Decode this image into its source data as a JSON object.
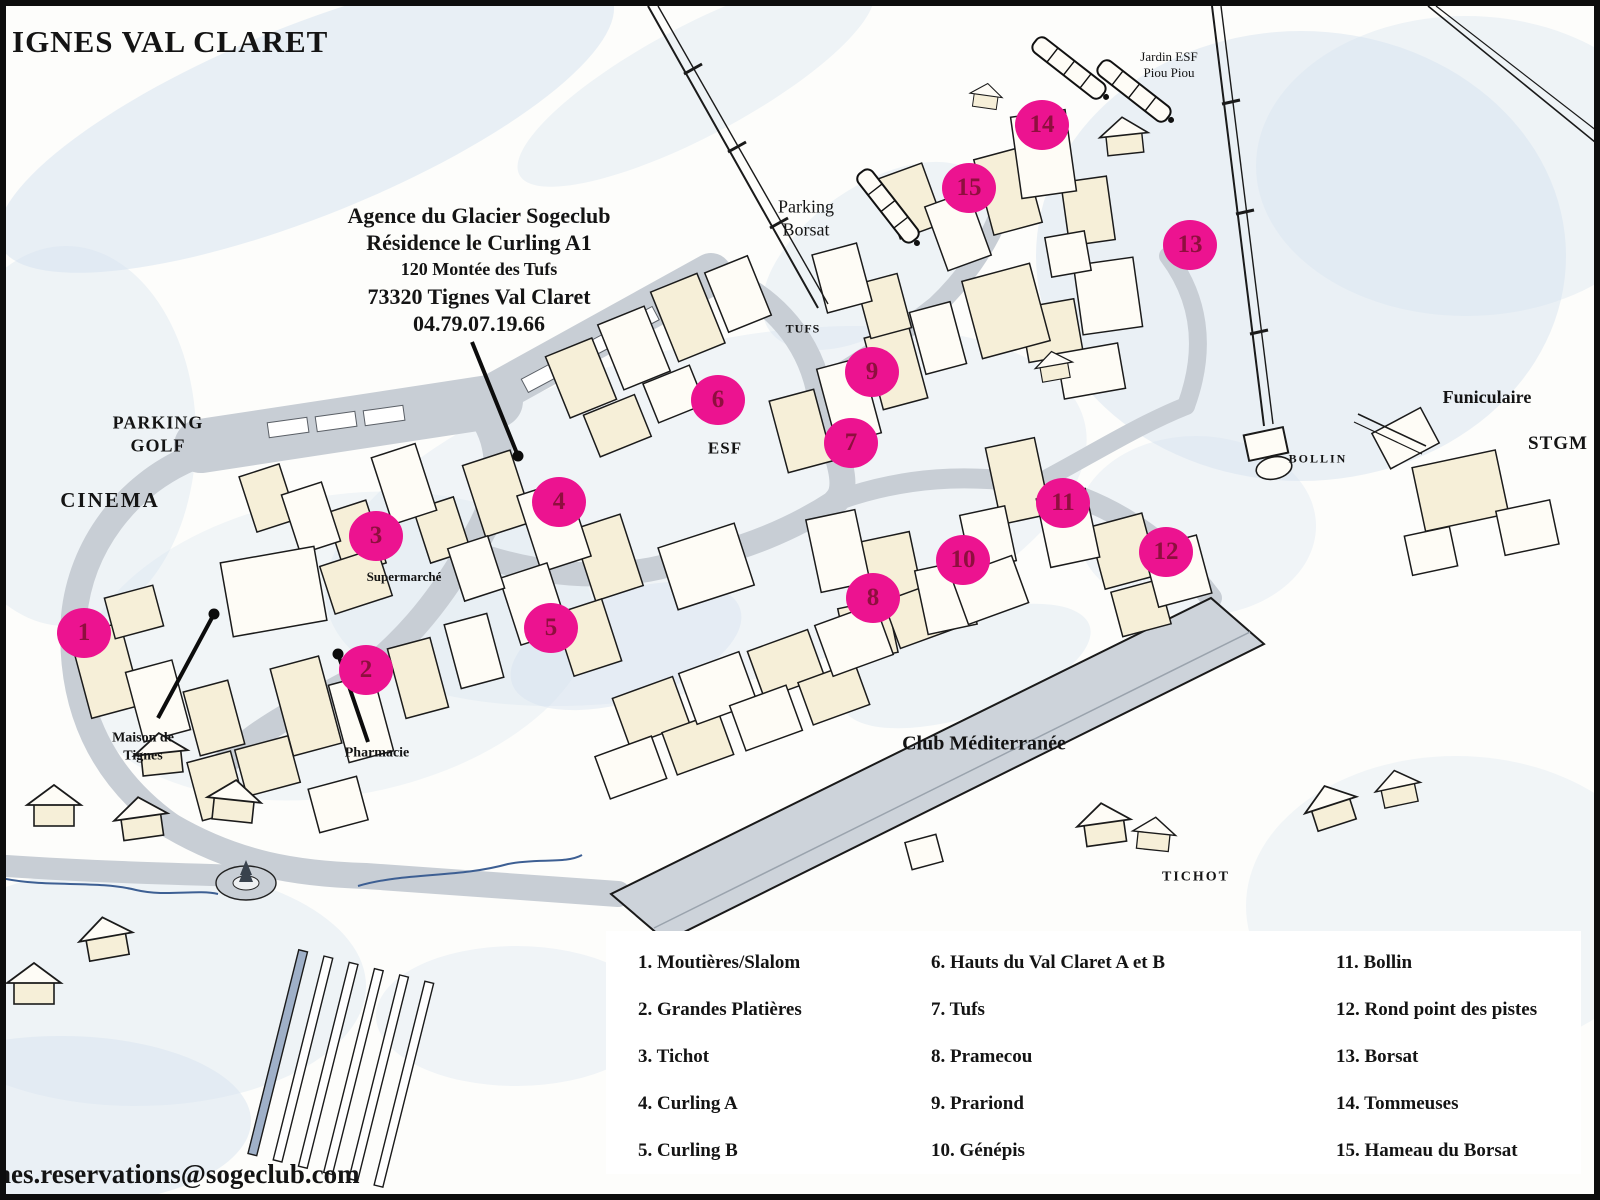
{
  "title": "IGNES VAL CLARET",
  "agency": {
    "line1": "Agence du Glacier Sogeclub",
    "line2": "Résidence le Curling A1",
    "line3": "120 Montée des Tufs",
    "line4": "73320 Tignes Val Claret",
    "line5": "04.79.07.19.66"
  },
  "email": "nes.reservations@sogeclub.com",
  "colors": {
    "marker_fill": "#ec1390",
    "marker_number": "#8e0f3e",
    "road": "#c8ced5",
    "wash": "#d7e3f0",
    "building_cream": "#f6efd8",
    "building_white": "#fefcf6"
  },
  "map_labels": [
    {
      "id": "parking-golf",
      "lines": [
        "PARKING",
        "GOLF"
      ],
      "x": 152,
      "y": 428,
      "size": 18,
      "weight": "bold",
      "ls": 1
    },
    {
      "id": "cinema",
      "lines": [
        "CINEMA"
      ],
      "x": 104,
      "y": 494,
      "size": 21,
      "weight": "bold",
      "ls": 2
    },
    {
      "id": "supermarche",
      "lines": [
        "Supermarché"
      ],
      "x": 398,
      "y": 571,
      "size": 13,
      "weight": "bold",
      "ls": 0
    },
    {
      "id": "maison-de-tignes",
      "lines": [
        "Maison de",
        "Tignes"
      ],
      "x": 137,
      "y": 741,
      "size": 14,
      "weight": "bold",
      "ls": 0
    },
    {
      "id": "pharmacie",
      "lines": [
        "Pharmacie"
      ],
      "x": 371,
      "y": 747,
      "size": 14,
      "weight": "bold",
      "ls": 0
    },
    {
      "id": "parking-borsat",
      "lines": [
        "Parking",
        "Borsat"
      ],
      "x": 800,
      "y": 212,
      "size": 18,
      "weight": "normal",
      "ls": 0
    },
    {
      "id": "tufs",
      "lines": [
        "TUFS"
      ],
      "x": 797,
      "y": 323,
      "size": 12,
      "weight": "bold",
      "ls": 1
    },
    {
      "id": "esf",
      "lines": [
        "ESF"
      ],
      "x": 719,
      "y": 442,
      "size": 17,
      "weight": "bold",
      "ls": 1
    },
    {
      "id": "jardin-esf-piou-piou",
      "lines": [
        "Jardin ESF",
        "Piou Piou"
      ],
      "x": 1163,
      "y": 59,
      "size": 13,
      "weight": "normal",
      "ls": 0
    },
    {
      "id": "funiculaire",
      "lines": [
        "Funiculaire"
      ],
      "x": 1481,
      "y": 391,
      "size": 18,
      "weight": "bold",
      "ls": 0
    },
    {
      "id": "stgm",
      "lines": [
        "STGM"
      ],
      "x": 1552,
      "y": 438,
      "size": 19,
      "weight": "bold",
      "ls": 1
    },
    {
      "id": "bollin",
      "lines": [
        "BOLLIN"
      ],
      "x": 1312,
      "y": 453,
      "size": 12,
      "weight": "bold",
      "ls": 2
    },
    {
      "id": "club-mediterranee",
      "lines": [
        "Club Méditerranée"
      ],
      "x": 978,
      "y": 738,
      "size": 20,
      "weight": "bold",
      "ls": 0
    },
    {
      "id": "tichot",
      "lines": [
        "TICHOT"
      ],
      "x": 1190,
      "y": 871,
      "size": 14,
      "weight": "bold",
      "ls": 2
    }
  ],
  "markers": [
    {
      "number": "1",
      "x": 78,
      "y": 627
    },
    {
      "number": "2",
      "x": 360,
      "y": 664
    },
    {
      "number": "3",
      "x": 370,
      "y": 530
    },
    {
      "number": "4",
      "x": 553,
      "y": 496
    },
    {
      "number": "5",
      "x": 545,
      "y": 622
    },
    {
      "number": "6",
      "x": 712,
      "y": 394
    },
    {
      "number": "7",
      "x": 845,
      "y": 437
    },
    {
      "number": "8",
      "x": 867,
      "y": 592
    },
    {
      "number": "9",
      "x": 866,
      "y": 366
    },
    {
      "number": "10",
      "x": 957,
      "y": 554
    },
    {
      "number": "11",
      "x": 1057,
      "y": 497
    },
    {
      "number": "12",
      "x": 1160,
      "y": 546
    },
    {
      "number": "13",
      "x": 1184,
      "y": 239
    },
    {
      "number": "14",
      "x": 1036,
      "y": 119
    },
    {
      "number": "15",
      "x": 963,
      "y": 182
    }
  ],
  "legend": {
    "columns": [
      {
        "x": 32,
        "items": [
          {
            "num": "1",
            "name": "Moutières/Slalom"
          },
          {
            "num": "2",
            "name": "Grandes Platières"
          },
          {
            "num": "3",
            "name": "Tichot"
          },
          {
            "num": "4",
            "name": "Curling A"
          },
          {
            "num": "5",
            "name": "Curling B"
          }
        ]
      },
      {
        "x": 325,
        "items": [
          {
            "num": "6",
            "name": "Hauts du Val Claret A et B"
          },
          {
            "num": "7",
            "name": "Tufs"
          },
          {
            "num": "8",
            "name": "Pramecou"
          },
          {
            "num": "9",
            "name": "Prariond"
          },
          {
            "num": "10",
            "name": "Génépis"
          }
        ]
      },
      {
        "x": 730,
        "items": [
          {
            "num": "11",
            "name": "Bollin"
          },
          {
            "num": "12",
            "name": "Rond point des pistes"
          },
          {
            "num": "13",
            "name": "Borsat"
          },
          {
            "num": "14",
            "name": "Tommeuses"
          },
          {
            "num": "15",
            "name": "Hameau du Borsat"
          }
        ]
      }
    ]
  }
}
